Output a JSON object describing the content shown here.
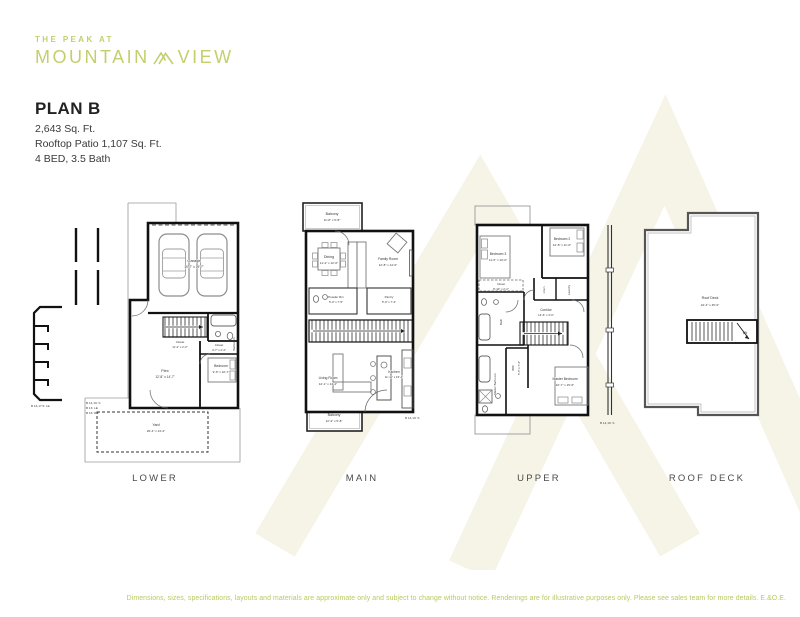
{
  "logo": {
    "tagline": "THE PEAK AT",
    "brand_left": "MOUNTAIN",
    "brand_right": "VIEW"
  },
  "plan_info": {
    "title": "PLAN B",
    "line1": "2,643 Sq. Ft.",
    "line2": "Rooftop Patio 1,107 Sq. Ft.",
    "line3": "4 BED, 3.5 Bath"
  },
  "floors": {
    "lower": {
      "label": "LOWER",
      "garage_name": "Garage",
      "garage_dims": "19'-7\" x 19'-7\"",
      "flex_name": "Flex",
      "flex_dims": "12'-8\" x 14'-7\"",
      "bedroom_name": "Bedroom",
      "bedroom_dims": "9'-6\" x 10'-7\"",
      "closet1_name": "Closet",
      "closet1_dims": "11'-2\" x 2'-2\"",
      "closet2_name": "Closet",
      "closet2_dims": "4'-7\" x 2'-2\"",
      "bathroom_name": "Bathroom",
      "yard_name": "Yard",
      "yard_dims": "29'-4\" x 13'-2\"",
      "note1": "B 16,17.5: LE",
      "note2": "B 14,19: S",
      "note3": "B 13: LE",
      "note4": "B 16: RB"
    },
    "main": {
      "label": "MAIN",
      "balcony_top_name": "Balcony",
      "balcony_top_dims": "11'-8\" x 5'-8\"",
      "dining_name": "Dining",
      "dining_dims": "11'-4\" x 12'-6\"",
      "family_name": "Family Room",
      "family_dims": "12'-8\" x 14'-0\"",
      "powder_name": "Powder Rm",
      "powder_dims": "5'-0\" x 7'-5\"",
      "pantry_name": "Pantry",
      "pantry_dims": "5'-0\" x 7'-4\"",
      "living_name": "Living Room",
      "living_dims": "12'-1\" x 14'-4\"",
      "kitchen_name": "Kitchen",
      "kitchen_dims": "11'-11\" x 15'-4\"",
      "balcony_bottom_name": "Balcony",
      "balcony_bottom_dims": "12'-3\" x 5'-8\"",
      "note1": "B 14,19: S"
    },
    "upper": {
      "label": "UPPER",
      "bedroom3_name": "Bedroom 3",
      "bedroom3_dims": "11'-6\" x 10'-6\"",
      "bedroom2_name": "Bedroom 2",
      "bedroom2_dims": "12'-8\" x 11'-6\"",
      "closet_name": "Closet",
      "closet_dims": "8'-10\" x 2'-2\"",
      "linen_name": "Linen",
      "laundry_name": "Laundry",
      "corridor_name": "Corridor",
      "corridor_dims": "14'-6\" x 4'-6\"",
      "bath_name": "Bath",
      "wic_name": "WIC",
      "wic_dims": "5'-5\" x 7'-4\"",
      "master_bed_name": "Master Bedroom",
      "master_bed_dims": "16'-7\" x 15'-6\"",
      "master_bath_name": "Master Bathroom",
      "note1": "B 14,16: S"
    },
    "roof": {
      "label": "ROOF DECK",
      "deck_name": "Roof Deck",
      "deck_dims": "24'-4\" x 45'-0\"",
      "stairs_label": "DN"
    }
  },
  "disclaimer": "Dimensions, sizes, specifications, layouts and materials are approximate only and subject to change without notice. Renderings are for illustrative purposes only. Please see sales team for more details. E.&O.E.",
  "colors": {
    "brand_green": "#c3cf6d",
    "disclaimer_green": "#b9c95f",
    "ink": "#232323",
    "watermark_cream": "#f6f3e7"
  }
}
